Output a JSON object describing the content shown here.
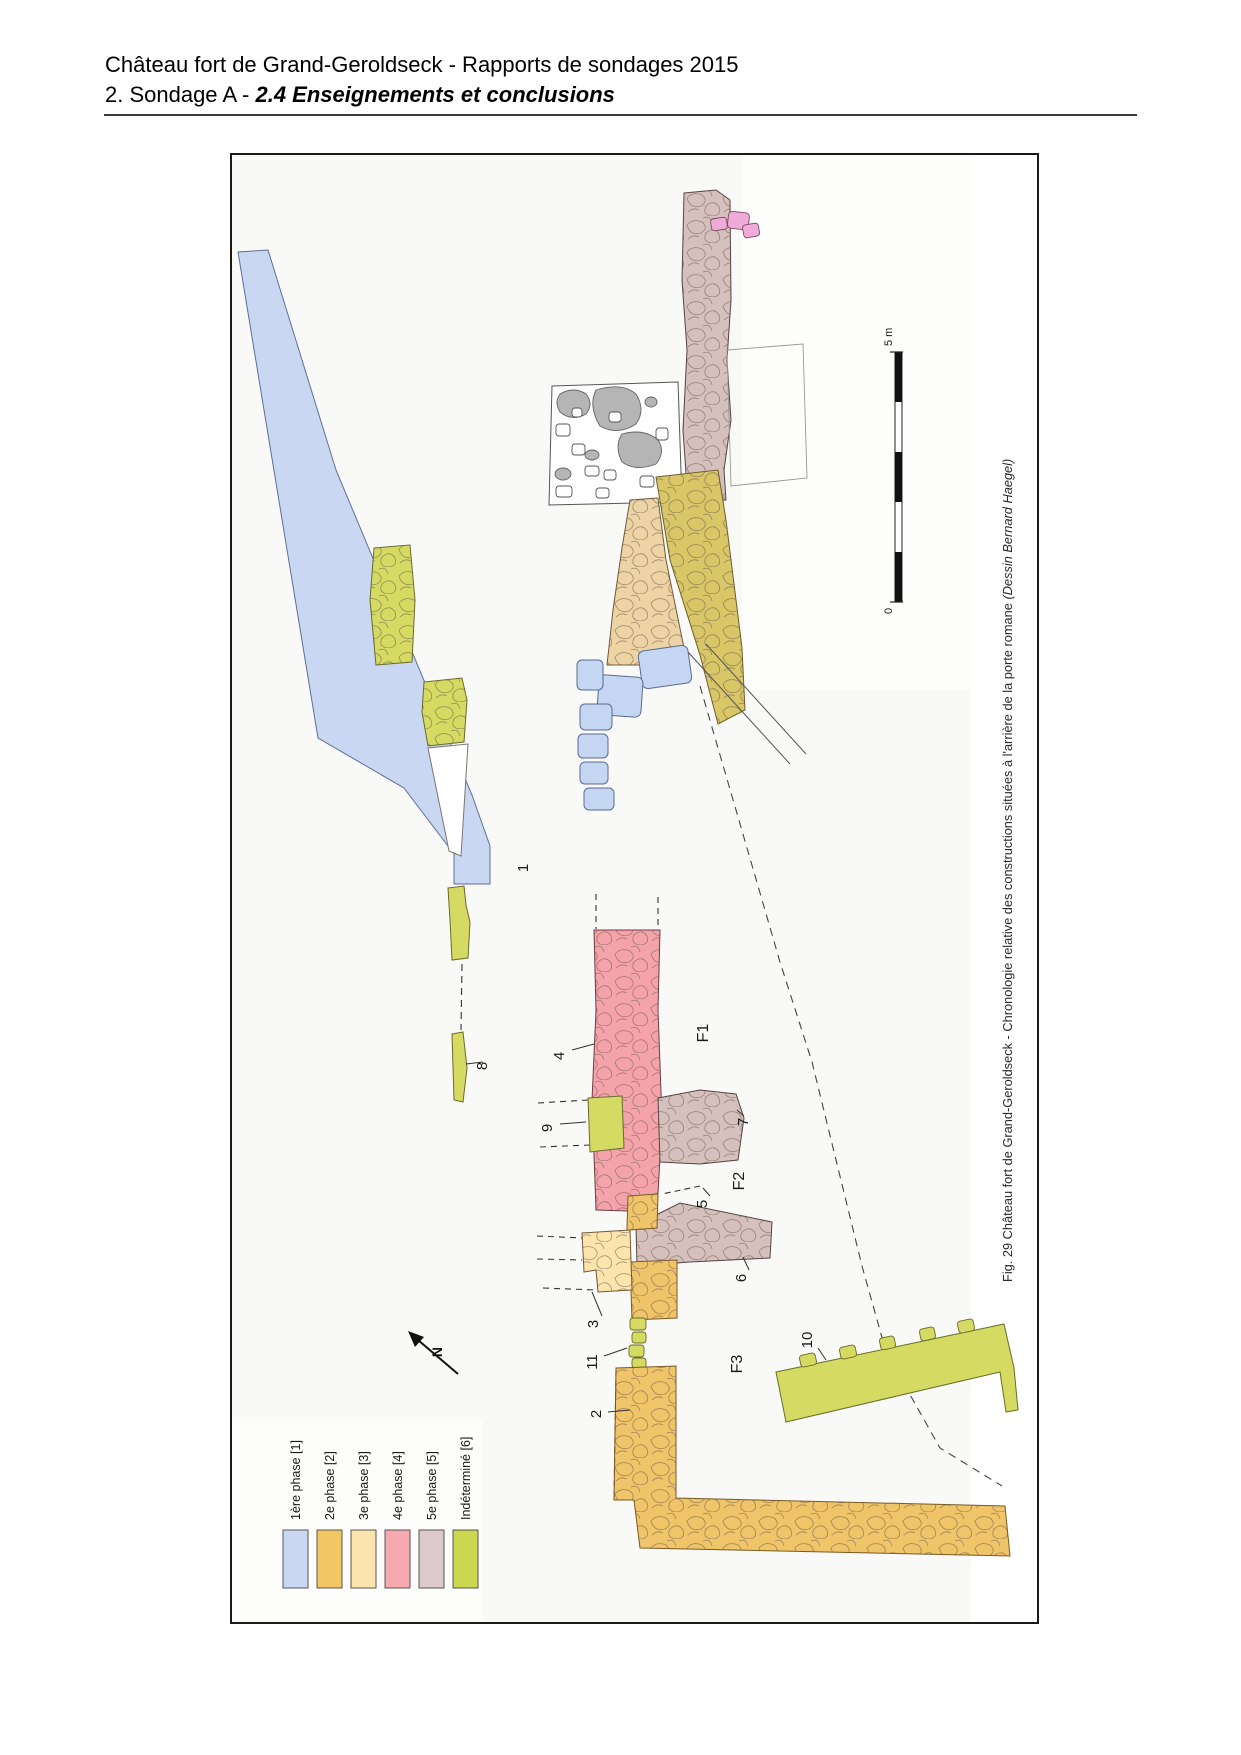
{
  "page": {
    "header_line1": "Château fort de Grand-Geroldseck - Rapports de sondages 2015",
    "header_line2_prefix": "2. Sondage A - ",
    "header_line2_emphasis": "2.4 Enseignements et conclusions"
  },
  "figure": {
    "caption_text": "Fig. 29 Château fort de Grand-Geroldseck - Chronologie relative des constructions situées à l'arrière de la porte romane ",
    "caption_credit": "(Dessin Bernard Haegel)",
    "north_label": "N",
    "scale_bar": {
      "top_label": "5 m",
      "bottom_label": "0"
    },
    "legend": {
      "items": [
        {
          "label": "1ère phase [1]",
          "color": "#c9d7f2"
        },
        {
          "label": "2e phase [2]",
          "color": "#f2c664"
        },
        {
          "label": "3e phase [3]",
          "color": "#fce5ad"
        },
        {
          "label": "4e phase [4]",
          "color": "#f6a9b1"
        },
        {
          "label": "5e phase [5]",
          "color": "#dcc9c9"
        },
        {
          "label": "Indéterminé [6]",
          "color": "#ccd750"
        }
      ]
    },
    "plan_labels": {
      "l1": "1",
      "l2": "2",
      "l3": "3",
      "l4": "4",
      "l5": "5",
      "l6": "6",
      "l7": "7",
      "l8": "8",
      "l9": "9",
      "l10": "10",
      "l11": "11",
      "f1": "F1",
      "f2": "F2",
      "f3": "F3"
    }
  }
}
